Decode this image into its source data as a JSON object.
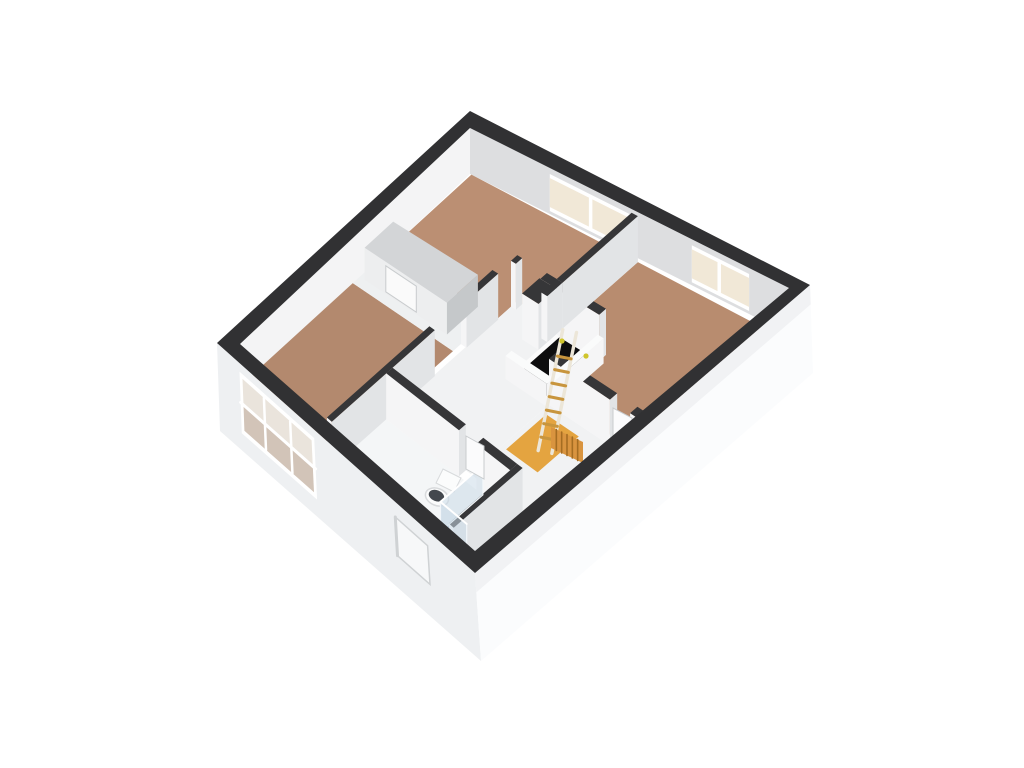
{
  "app": {
    "name": "3d-floorplan-viewer",
    "background": "#ffffff"
  },
  "scene": {
    "view": {
      "corner_n": [
        470,
        111
      ],
      "corner_e": [
        810,
        285
      ],
      "corner_s": [
        475,
        573
      ],
      "corner_w": [
        217,
        343
      ],
      "inner_n": [
        470,
        128
      ],
      "inner_e": [
        789,
        288
      ],
      "inner_s": [
        475,
        551
      ],
      "inner_w": [
        240,
        344
      ],
      "base_e": [
        813,
        373
      ],
      "base_s": [
        481,
        661
      ],
      "base_w": [
        220,
        431
      ],
      "plan_q": 64,
      "plan_p": 54,
      "floor_drop": 46
    },
    "palette": {
      "background": "#ffffff",
      "wall_cap_dark": "#363638",
      "wall_cap_light": "#fafbfb",
      "ext_band": "#313133",
      "ext_face_sw": "#eef0f2",
      "ext_face_se": "#fbfcfd",
      "ext_face_se_shade": "#f1f2f4",
      "int_face_lit": "#f5f5f6",
      "int_face_shade": "#e2e4e6",
      "nw_face": "#f4f4f5",
      "ne_face": "#dddee0",
      "floor_north": "#bb8f73",
      "floor_east": "#b88c6f",
      "floor_west": "#b3896e",
      "floor_hall": "#f1f2f3",
      "floor_corridor": "#eef0f1",
      "floor_void": "#f4f5f6",
      "floor_bath": "#f4f6f7",
      "floor_shower": "#a6bedb",
      "floor_landing": "#e4a440",
      "stair_hole": "#0d0d0e",
      "stair_curb": "#fbfbfb",
      "frame_white": "#ffffff",
      "glass_cream": "#f1e8d7",
      "glass_ext_top": "#eae4dc",
      "glass_ext_bottom": "#d2c4b8",
      "recess_fill": "#f7f8f9",
      "recess_shadow": "#cfd2d4",
      "closet_cap": "#d3d5d7",
      "closet_front": "#edeeef",
      "closet_side": "#c5c8ca",
      "closet_door": "#fafafa",
      "door_leaf": "#fbfbfc",
      "door_edge": "#c9ccce",
      "ladder_rail": "#ece6d8",
      "ladder_rung": "#c8953d",
      "radiator": "#d9943f",
      "radiator_stripe": "#a56d22",
      "toilet_body": "#fbfcfc",
      "toilet_rim": "#d8dadc",
      "toilet_seat": "#43484e",
      "glass_panel": "rgba(203,218,231,0.55)",
      "glass_edge": "#f2f6f9",
      "spot_dot": "#cfc52c"
    },
    "floors": [
      {
        "name": "floor-bedroom-north",
        "color": "floor_north",
        "pts": [
          [
            2.5,
            2.5
          ],
          [
            33,
            2.5
          ],
          [
            33,
            16.2
          ],
          [
            25,
            16.2
          ],
          [
            25,
            20
          ],
          [
            2.5,
            20
          ]
        ]
      },
      {
        "name": "floor-bedroom-east",
        "color": "floor_east",
        "pts": [
          [
            34.2,
            2.5
          ],
          [
            61.5,
            2.5
          ],
          [
            61.5,
            25
          ],
          [
            43,
            25
          ],
          [
            43,
            16.2
          ],
          [
            34.2,
            16.2
          ]
        ]
      },
      {
        "name": "floor-bedroom-west",
        "color": "floor_west",
        "pts": [
          [
            2.5,
            27.5
          ],
          [
            24,
            27.5
          ],
          [
            24,
            51.5
          ],
          [
            2.5,
            51.5
          ]
        ]
      },
      {
        "name": "floor-hall",
        "color": "floor_hall",
        "pts": [
          [
            25,
            16.2
          ],
          [
            43,
            16.2
          ],
          [
            43,
            40
          ],
          [
            25,
            40
          ]
        ]
      },
      {
        "name": "floor-hall-east",
        "color": "floor_hall",
        "pts": [
          [
            43,
            26.2
          ],
          [
            55,
            26.2
          ],
          [
            55,
            40
          ],
          [
            43,
            40
          ]
        ]
      },
      {
        "name": "floor-corridor-closet",
        "color": "floor_corridor",
        "pts": [
          [
            2.5,
            20
          ],
          [
            24,
            20
          ],
          [
            24,
            27.5
          ],
          [
            2.5,
            27.5
          ]
        ]
      },
      {
        "name": "floor-void-se",
        "color": "floor_void",
        "pts": [
          [
            55,
            26.2
          ],
          [
            61.5,
            26.2
          ],
          [
            61.5,
            51.5
          ],
          [
            55,
            51.5
          ]
        ]
      },
      {
        "name": "floor-bathroom",
        "color": "floor_bath",
        "pts": [
          [
            25.2,
            41.2
          ],
          [
            53.8,
            41.2
          ],
          [
            53.8,
            51.5
          ],
          [
            25.2,
            51.5
          ]
        ]
      },
      {
        "name": "floor-shower",
        "color": "floor_shower",
        "pts": [
          [
            47.5,
            41.2
          ],
          [
            53.8,
            41.2
          ],
          [
            53.8,
            48.5
          ],
          [
            47.5,
            48.5
          ]
        ]
      },
      {
        "name": "floor-landing",
        "color": "floor_landing",
        "pts": [
          [
            44,
            27.5
          ],
          [
            51,
            27.5
          ],
          [
            51,
            34.5
          ],
          [
            44,
            34.5
          ]
        ]
      }
    ],
    "stairwell": {
      "curb": {
        "q": [
          34.2,
          42.6
        ],
        "p": [
          16.8,
          26.4
        ]
      },
      "hole": {
        "q": [
          35,
          41.5
        ],
        "p": [
          17.5,
          25.5
        ]
      },
      "dots": [
        [
          562,
          341
        ],
        [
          586,
          356
        ]
      ]
    },
    "walls": [
      {
        "name": "wall-north-room-south-a",
        "q": [
          25,
          26
        ],
        "p": [
          16.2,
          17.4
        ]
      },
      {
        "name": "wall-north-room-south-b",
        "q": [
          31,
          43
        ],
        "p": [
          16.2,
          17.4
        ]
      },
      {
        "name": "wall-duct-column",
        "q": [
          30.8,
          34.2
        ],
        "p": [
          17.4,
          20.6
        ]
      },
      {
        "name": "wall-north-east-divider",
        "q": [
          33,
          34.2
        ],
        "p": [
          2.5,
          16.2
        ]
      },
      {
        "name": "wall-divider-stub",
        "q": [
          33,
          34.2
        ],
        "p": [
          16.2,
          19
        ]
      },
      {
        "name": "wall-east-room-south-a",
        "q": [
          43,
          56
        ],
        "p": [
          25,
          26.2
        ]
      },
      {
        "name": "wall-east-room-south-b",
        "q": [
          60.3,
          61.5
        ],
        "p": [
          25,
          26.2
        ]
      },
      {
        "name": "wall-west-room-east-a",
        "q": [
          24,
          25.2
        ],
        "p": [
          20,
          26
        ]
      },
      {
        "name": "wall-west-room-east-b",
        "q": [
          24,
          25.2
        ],
        "p": [
          32,
          51.5
        ]
      },
      {
        "name": "wall-bathroom-north-a",
        "q": [
          25.2,
          42
        ],
        "p": [
          40,
          41.2
        ]
      },
      {
        "name": "wall-bathroom-north-b",
        "q": [
          46,
          53.8
        ],
        "p": [
          40,
          41.2
        ]
      },
      {
        "name": "wall-bathroom-east",
        "q": [
          53.8,
          55
        ],
        "p": [
          40,
          51.5
        ]
      },
      {
        "name": "balustrade-stair-east",
        "q": [
          42.7,
          43.9
        ],
        "p": [
          17.4,
          26.2
        ],
        "h": 0.55,
        "light": true
      },
      {
        "name": "balustrade-stair-south",
        "q": [
          34.2,
          43
        ],
        "p": [
          25.5,
          26.6
        ],
        "h": 0.5,
        "light": true
      }
    ],
    "closet": {
      "q": [
        3.5,
        21
      ],
      "p": [
        20,
        26
      ],
      "cap_drop": 14,
      "door_q": [
        8,
        14.5
      ]
    },
    "ne_windows": [
      {
        "name": "window-north-bedroom",
        "q": [
          16,
          32.5
        ],
        "mullions": [
          24.2
        ]
      },
      {
        "name": "window-east-bedroom",
        "q": [
          44.5,
          56
        ],
        "mullions": [
          50
        ]
      }
    ],
    "sw_window": {
      "name": "window-west-bedroom",
      "q": [
        5.5,
        24
      ],
      "f_top": 0.1,
      "f_bottom": 0.8,
      "v_mullions": [
        11.5,
        18
      ],
      "h_mullion_f": 0.45
    },
    "sw_recess": {
      "name": "window-bathroom-recess",
      "q": [
        44,
        52
      ],
      "f_top": 0.18,
      "f_bottom": 0.62
    },
    "objects": {
      "ladder": {
        "top": [
          567,
          344
        ],
        "bottom": [
          545,
          452
        ],
        "width": 14,
        "rungs": 7
      },
      "radiator": {
        "pts": [
          [
            551,
            427
          ],
          [
            583,
            442
          ],
          [
            583,
            463
          ],
          [
            551,
            448
          ]
        ],
        "stripes": 5
      },
      "toilet": {
        "bowl": [
          437,
          497
        ],
        "rx": 12,
        "ry": 8.5,
        "rot": 22,
        "tank": [
          [
            443,
            469
          ],
          [
            461,
            478
          ],
          [
            454,
            492
          ],
          [
            436,
            483
          ]
        ]
      },
      "door_leaves": [
        {
          "name": "door-east-bedroom",
          "pts": [
            [
              613,
              408
            ],
            [
              632,
              418
            ],
            [
              632,
              452
            ],
            [
              613,
              442
            ]
          ]
        },
        {
          "name": "door-bathroom",
          "pts": [
            [
              466,
              436
            ],
            [
              484,
              446
            ],
            [
              484,
              479
            ],
            [
              466,
              469
            ]
          ]
        }
      ],
      "shower_panels": [
        {
          "name": "shower-glass-front",
          "q": 47.5,
          "p": [
            41.2,
            48.5
          ]
        },
        {
          "name": "shower-glass-side",
          "p": 48.5,
          "q": [
            47.5,
            53.8
          ]
        }
      ]
    }
  }
}
